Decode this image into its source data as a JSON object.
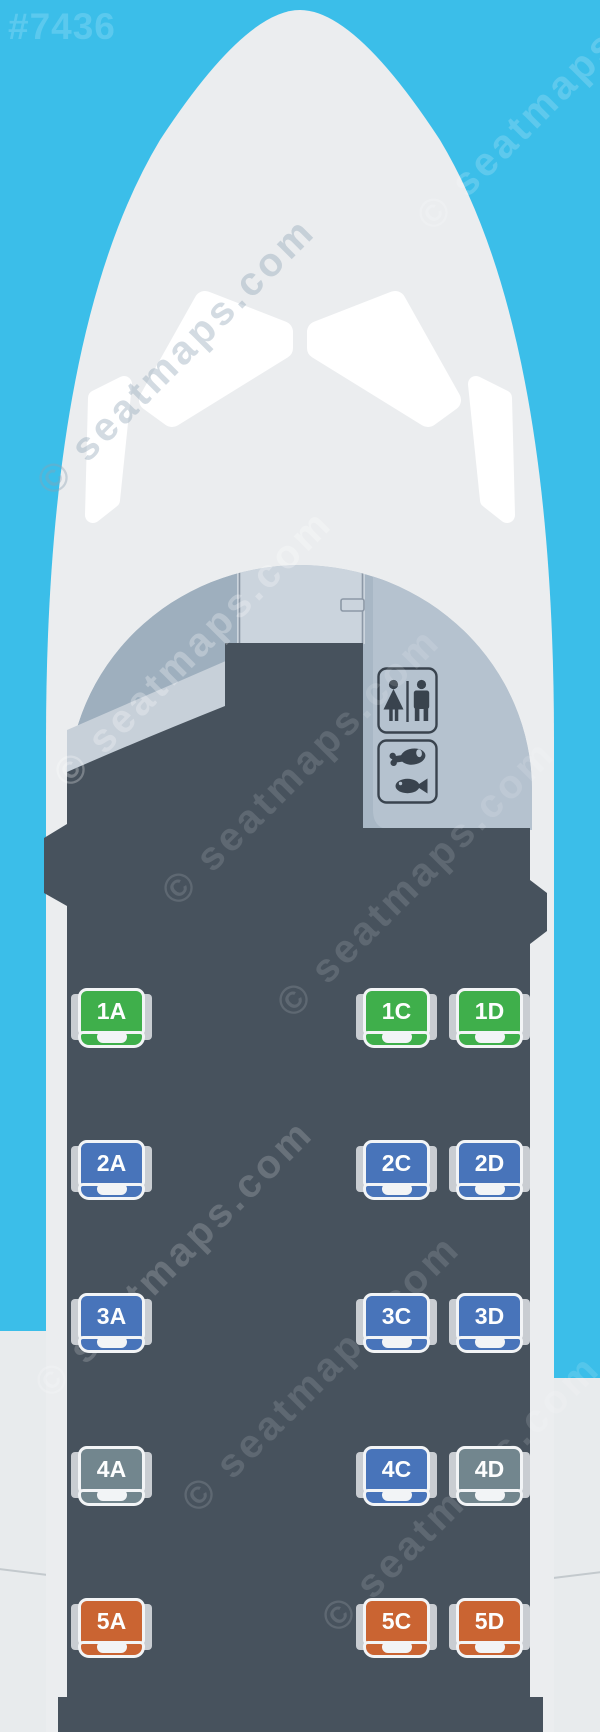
{
  "map_id": "#7436",
  "watermark": "© seatmaps.com",
  "colors": {
    "sky": "#3BBEE9",
    "fuselage": "#EBEDEF",
    "cabin_floor": "#47525D",
    "cabin_dome": "#A8B7C5",
    "cockpit_door_panel": "#CBD4DD",
    "galley_panel": "#B5C2CF",
    "armrest": "#C9CDD2",
    "seat_green": "#3FAF4B",
    "seat_blue": "#4874BA",
    "seat_gray": "#72868E",
    "seat_orange": "#CA6432"
  },
  "facilities": [
    {
      "label": "lavatory"
    },
    {
      "label": "galley"
    }
  ],
  "seats": [
    {
      "id": "1A",
      "type": "green"
    },
    {
      "id": "1C",
      "type": "green"
    },
    {
      "id": "1D",
      "type": "green"
    },
    {
      "id": "2A",
      "type": "blue"
    },
    {
      "id": "2C",
      "type": "blue"
    },
    {
      "id": "2D",
      "type": "blue"
    },
    {
      "id": "3A",
      "type": "blue"
    },
    {
      "id": "3C",
      "type": "blue"
    },
    {
      "id": "3D",
      "type": "blue"
    },
    {
      "id": "4A",
      "type": "gray"
    },
    {
      "id": "4C",
      "type": "blue"
    },
    {
      "id": "4D",
      "type": "gray"
    },
    {
      "id": "5A",
      "type": "orange"
    },
    {
      "id": "5C",
      "type": "orange"
    },
    {
      "id": "5D",
      "type": "orange"
    }
  ]
}
